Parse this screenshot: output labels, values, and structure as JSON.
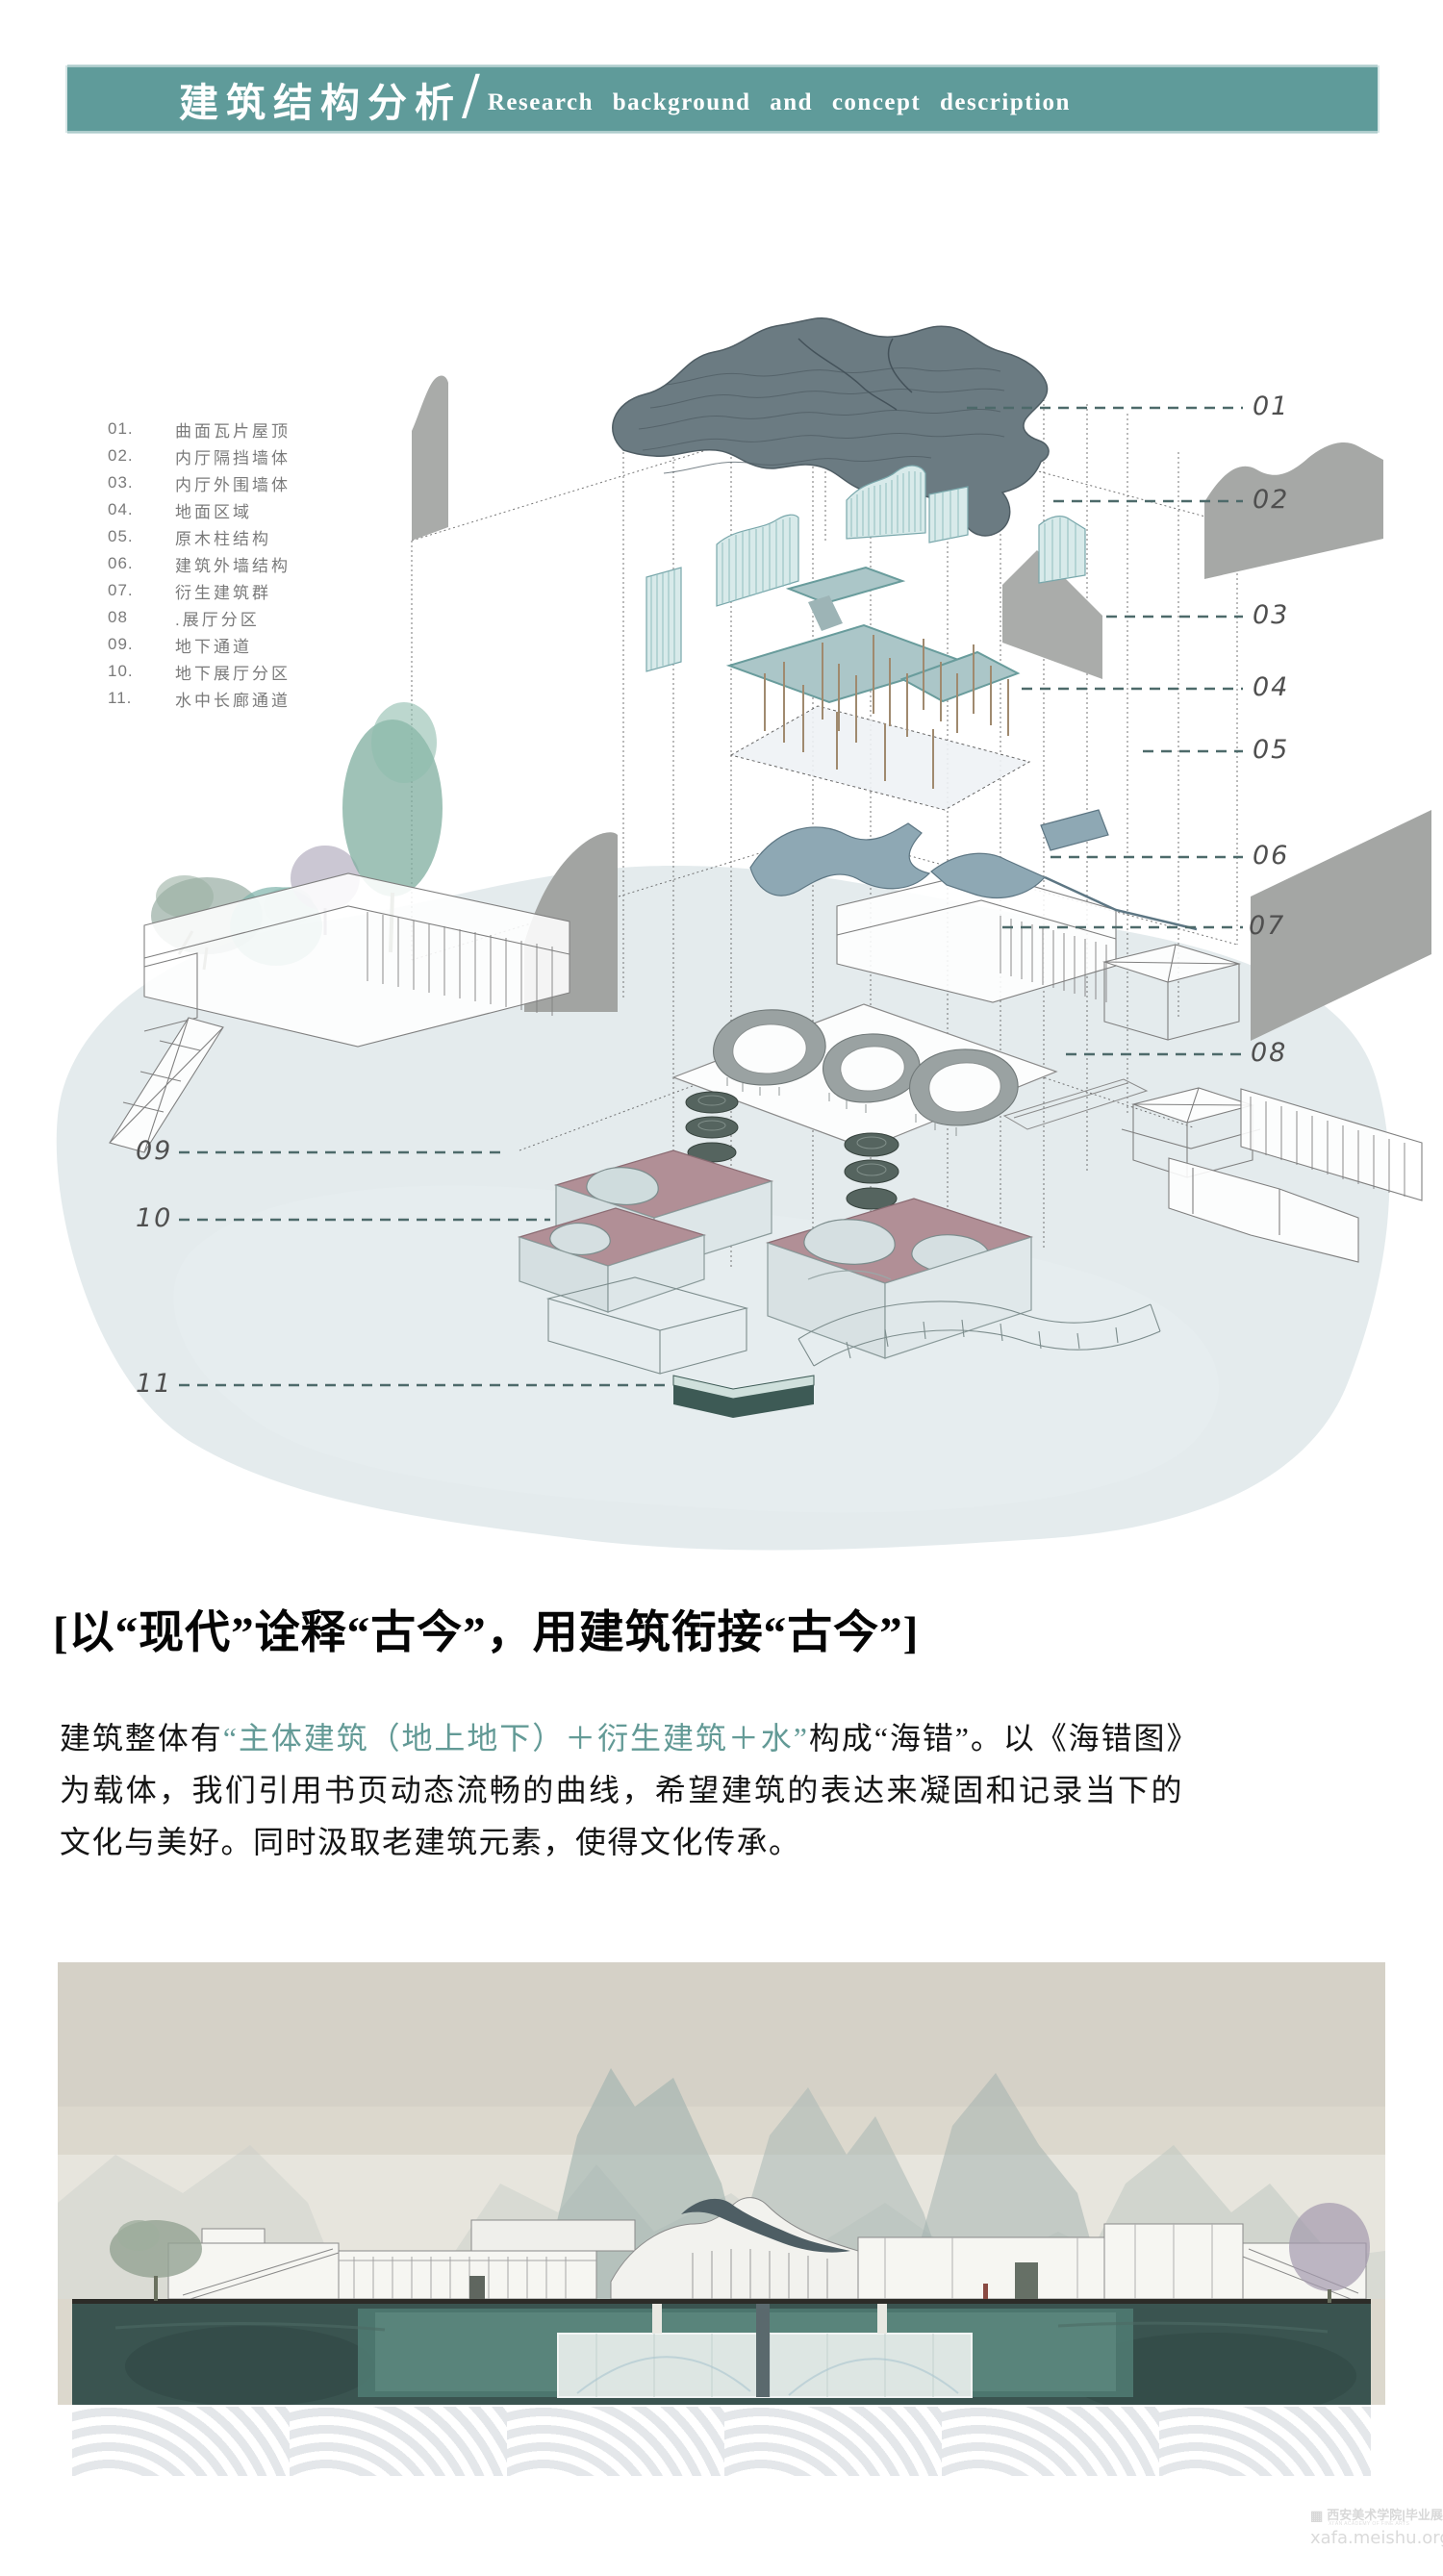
{
  "header": {
    "title_cn": "建筑结构分析",
    "slash": "/",
    "title_en": "Research background and concept description"
  },
  "legend": {
    "items": [
      {
        "num": "01.",
        "label": "曲面瓦片屋顶"
      },
      {
        "num": "02.",
        "label": "内厅隔挡墙体"
      },
      {
        "num": "03.",
        "label": "内厅外围墙体"
      },
      {
        "num": "04.",
        "label": "地面区域"
      },
      {
        "num": "05.",
        "label": "原木柱结构"
      },
      {
        "num": "06.",
        "label": "建筑外墙结构"
      },
      {
        "num": "07.",
        "label": "衍生建筑群"
      },
      {
        "num": "08",
        "label": ".展厅分区"
      },
      {
        "num": "09.",
        "label": "地下通道"
      },
      {
        "num": "10.",
        "label": "地下展厅分区"
      },
      {
        "num": "11.",
        "label": "水中长廊通道"
      }
    ]
  },
  "callouts": {
    "right": [
      "01",
      "02",
      "03",
      "04",
      "05",
      "06",
      "07",
      "08"
    ],
    "left": [
      "09",
      "10",
      "11"
    ]
  },
  "concept": {
    "headline": "[以“现代”诠释“古今”，用建筑衔接“古今”]",
    "body_prefix": "建筑整体有",
    "body_highlight": "“主体建筑（地上地下）＋衍生建筑＋水”",
    "body_suffix": "构成“海错”。以《海错图》为载体，我们引用书页动态流畅的曲线，希望建筑的表达来凝固和记录当下的文化与美好。同时汲取老建筑元素，使得文化传承。"
  },
  "colors": {
    "banner_teal": "#5f9b9a",
    "accent_teal": "#639a96",
    "callout_dash": "#4d6a6a",
    "roof_slate": "#6b7b82",
    "partition_teal": "#d8eaea",
    "ground_slab_teal": "#abc6c8",
    "structure_wall_blue": "#8ea8b4",
    "underground_pink": "#b18f96",
    "corridor_dark_teal": "#3d5a55",
    "water_wash": "#d8e2e6",
    "render_water_dark": "#3a5450"
  },
  "watermark": {
    "line1": "西安美术学院|毕业展",
    "line1_sub": "XI'AN ACADEMY OF FINE ARTS",
    "line2": "xafa.meishu.org.cn"
  }
}
